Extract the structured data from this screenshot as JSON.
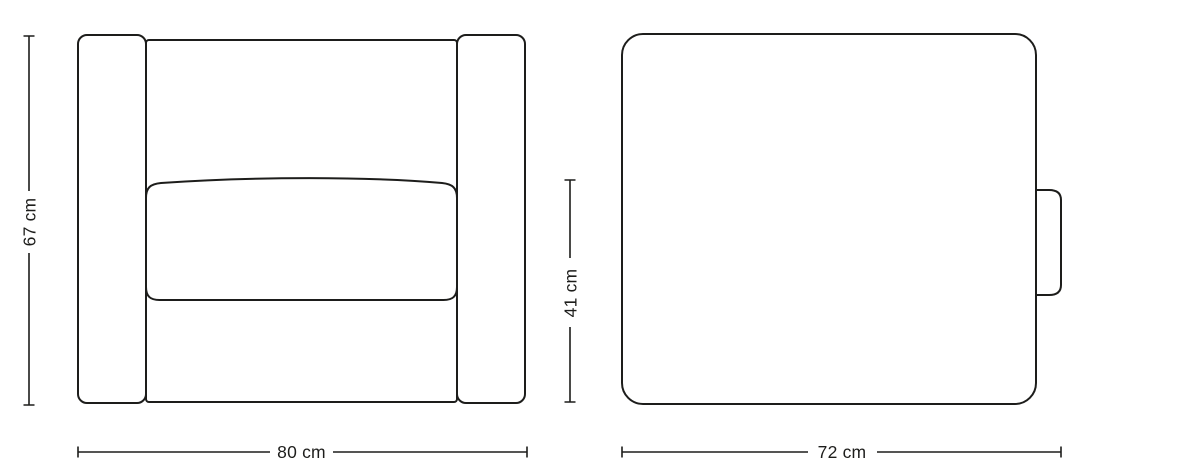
{
  "page": {
    "background": "#ffffff",
    "line_color": "#1d1d1b"
  },
  "diagram": {
    "title": "armchair-dimensions",
    "front_view": {
      "height_label": "67 cm",
      "width_label": "80 cm"
    },
    "side_view": {
      "seat_height_label": "41 cm",
      "depth_label": "72 cm"
    }
  }
}
